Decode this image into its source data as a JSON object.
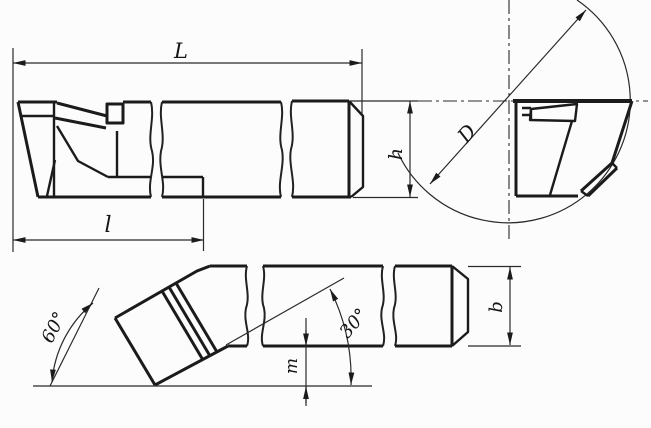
{
  "labels": {
    "overall_length": "L",
    "head_length": "l",
    "shank_height": "h",
    "bore_diameter": "D",
    "shank_width": "b",
    "tip_offset": "m",
    "bend_angle": "60°",
    "approach_angle": "30°"
  },
  "colors": {
    "ink": "#1b1b1b",
    "paper": "#fcfcfc"
  }
}
